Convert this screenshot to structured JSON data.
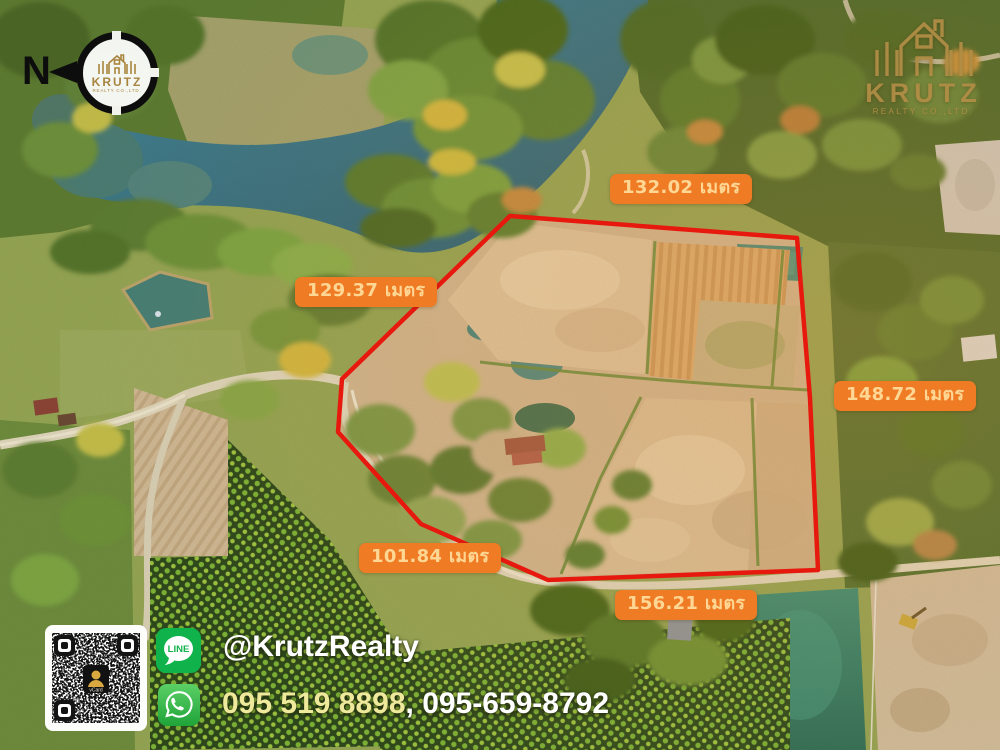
{
  "compass": {
    "label": "N"
  },
  "brand": {
    "name": "KRUTZ",
    "subtitle": "REALTY CO.,LTD."
  },
  "measurements": [
    {
      "side": "top",
      "text": "132.02 เมตร"
    },
    {
      "side": "upper-left",
      "text": "129.37 เมตร"
    },
    {
      "side": "right",
      "text": "148.72 เมตร"
    },
    {
      "side": "lower-left",
      "text": "101.84 เมตร"
    },
    {
      "side": "bottom",
      "text": "156.21 เมตร"
    }
  ],
  "unit": "เมตร",
  "contact": {
    "line_app_label": "LINE",
    "line_handle": "@KrutzRealty",
    "phone_primary": "095 519 8898",
    "phone_separator": ", ",
    "phone_secondary": "095-659-8792",
    "qr_center_label": "vCard"
  },
  "colors": {
    "boundary_red": "#E7190F",
    "label_bg": "#EF7B25",
    "label_text": "#FFD794",
    "line_green": "#10B24B",
    "whatsapp_green": "#2BB741",
    "brand_gold": "#B08D45",
    "phone_primary_color": "#EFE99C",
    "phone_secondary_color": "#FFFFFF"
  }
}
